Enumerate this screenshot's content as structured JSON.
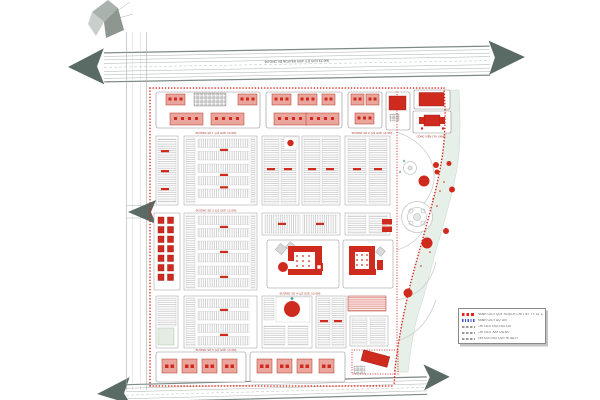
{
  "map": {
    "compass_icon": "north-arrow-sketch",
    "top_highway_label": "ĐƯỜNG VÕ NGUYÊN GIÁP (LỘ GIỚI 61.0M)",
    "road_labels": [
      "ĐƯỜNG SỐ 1 (LỘ GIỚI 13.0M)",
      "ĐƯỜNG SỐ 2 (LỘ GIỚI 13.0M)",
      "ĐƯỜNG SỐ 3 (LỘ GIỚI 13.0M)",
      "ĐƯỜNG SỐ 4 (LỘ GIỚI 13.0M)",
      "ĐƯỜNG SỐ 5 (LỘ GIỚI 13.0M)",
      "CÔNG VIÊN CÂY XANH"
    ],
    "legend": {
      "items": [
        {
          "symbol": "red-dashed-line",
          "color": "#e0231c",
          "label": "RANH GIỚI QUY HOẠCH CHI TIẾT TỶ LỆ 1/500"
        },
        {
          "symbol": "blue-dotted-line",
          "color": "#3b4fd4",
          "label": "RANH GIỚI DỰ ÁN"
        },
        {
          "symbol": "gray-dashed-line",
          "color": "#9a9a9a",
          "label": "CHỈ GIỚI ĐƯỜNG ĐỎ"
        },
        {
          "symbol": "gray-dashed-line",
          "color": "#9a9a9a",
          "label": "CHỈ GIỚI XÂY DỰNG"
        },
        {
          "symbol": "gray-dashed-line",
          "color": "#9a9a9a",
          "label": "TIM ĐƯỜNG QUY HOẠCH"
        }
      ]
    },
    "colors": {
      "boundary_red": "#e0231c",
      "building_red": "#cf2a1e",
      "building_salmon": "#eaa69c",
      "arrow_gray": "#5a6b66",
      "green_strip": "#e7efe9",
      "hatch_gray": "#9f9f9f",
      "legend_blue": "#3b4fd4"
    }
  }
}
